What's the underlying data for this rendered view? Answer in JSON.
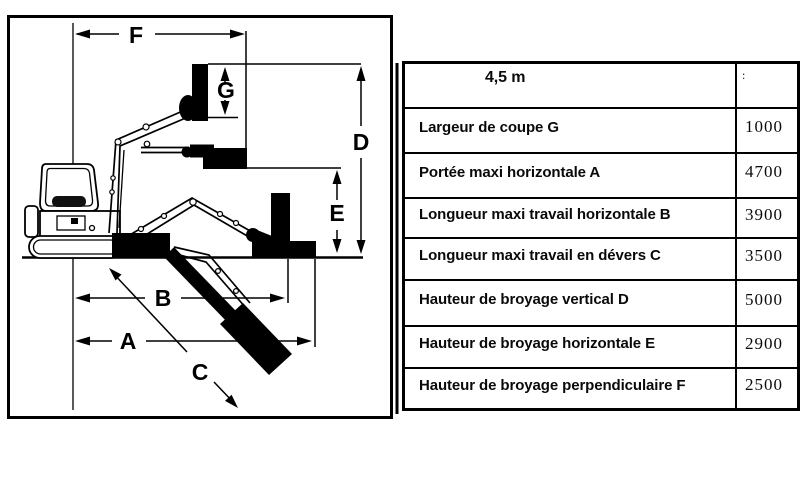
{
  "colors": {
    "ink": "#000000",
    "paper": "#ffffff"
  },
  "diagram": {
    "labels": {
      "f": "F",
      "g": "G",
      "d": "D",
      "e": "E",
      "b": "B",
      "a": "A",
      "c": "C"
    }
  },
  "table": {
    "header": {
      "span": "4,5 m",
      "unit": ":"
    },
    "rows": [
      {
        "label": "Largeur de coupe G",
        "value": "1000"
      },
      {
        "label": "Portée maxi horizontale A",
        "value": "4700"
      },
      {
        "label": "Longueur maxi travail horizontale B",
        "value": "3900"
      },
      {
        "label": "Longueur maxi travail en dévers C",
        "value": "3500"
      },
      {
        "label": "Hauteur de broyage vertical D",
        "value": "5000"
      },
      {
        "label": "Hauteur de broyage horizontale E",
        "value": "2900"
      },
      {
        "label": "Hauteur de broyage perpendiculaire F",
        "value": "2500"
      }
    ]
  }
}
